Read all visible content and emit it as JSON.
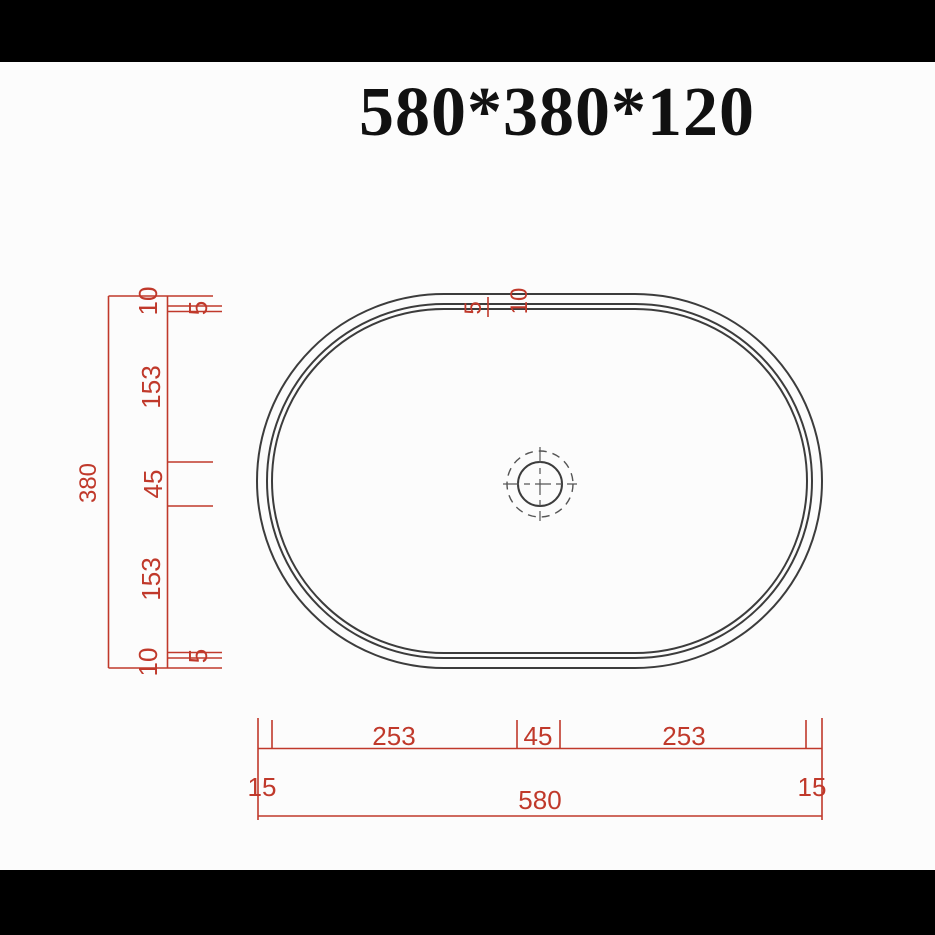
{
  "title": "580*380*120",
  "colors": {
    "dimension_red": "#c0392b",
    "outline_black": "#3c3c3c",
    "centerline_gray": "#555555",
    "paper_white": "#fcfcfc",
    "frame_black": "#000000"
  },
  "vertical_chain": {
    "overall": "380",
    "seg_10_top": "10",
    "seg_5_top": "5",
    "seg_153_upper": "153",
    "seg_45": "45",
    "seg_153_lower": "153",
    "seg_5_bottom": "5",
    "seg_10_bottom": "10"
  },
  "rim": {
    "seg_5": "5",
    "seg_10": "10"
  },
  "horizontal_chain": {
    "seg_15_left": "15",
    "seg_253_left": "253",
    "seg_45": "45",
    "seg_253_right": "253",
    "seg_15_right": "15",
    "overall": "580"
  }
}
